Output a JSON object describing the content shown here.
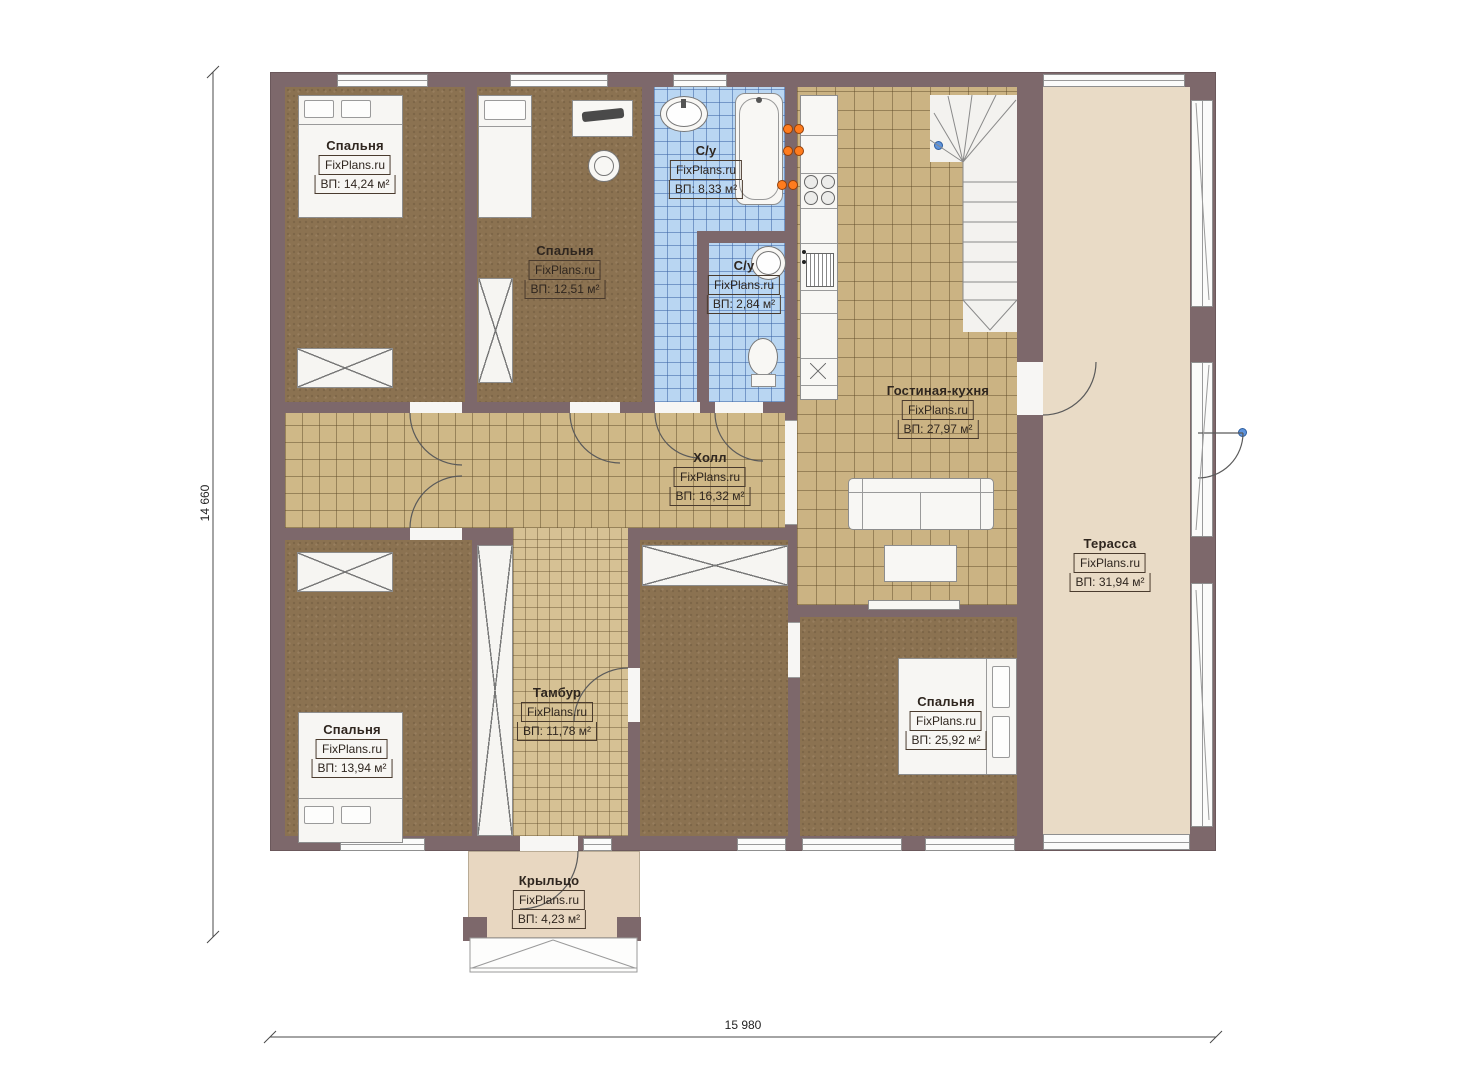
{
  "plan": {
    "brand": "FixPlans.ru",
    "dim_left": "14 660",
    "dim_bottom": "15 980",
    "rooms": {
      "bedroom_tl": {
        "name": "Спальня",
        "area": "ВП: 14,24 м²"
      },
      "bedroom_t2": {
        "name": "Спальня",
        "area": "ВП: 12,51 м²"
      },
      "bath_main": {
        "name": "С/у",
        "area": "ВП: 8,33 м²"
      },
      "bath_small": {
        "name": "С/у",
        "area": "ВП: 2,84 м²"
      },
      "living_kitchen": {
        "name": "Гостиная-кухня",
        "area": "ВП: 27,97 м²"
      },
      "hall": {
        "name": "Холл",
        "area": "ВП: 16,32 м²"
      },
      "terrace": {
        "name": "Терасса",
        "area": "ВП: 31,94 м²"
      },
      "bedroom_bl": {
        "name": "Спальня",
        "area": "ВП: 13,94 м²"
      },
      "vestibule": {
        "name": "Тамбур",
        "area": "ВП: 11,78 м²"
      },
      "bedroom_br": {
        "name": "Спальня",
        "area": "ВП: 25,92 м²"
      },
      "porch": {
        "name": "Крыльцо",
        "area": "ВП: 4,23 м²"
      }
    },
    "colors": {
      "wall": "#7d686b",
      "bedroom_floor": "#8b7251",
      "tile_tan": "#cfb887",
      "bath_tile": "#b9d6f2",
      "terrace_floor": "#e9dbc6",
      "accent_orange": "#ff7c1e",
      "marker_blue": "#5d93dc"
    }
  }
}
